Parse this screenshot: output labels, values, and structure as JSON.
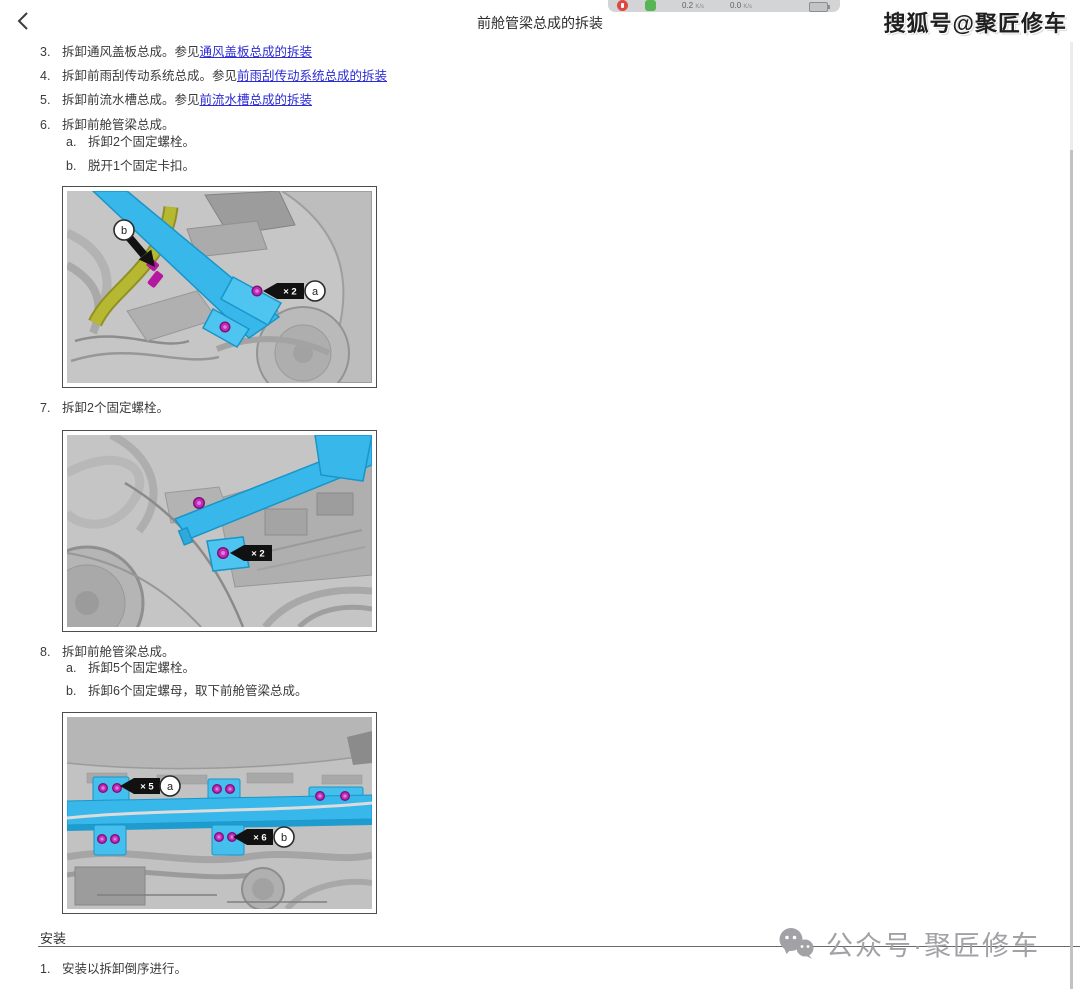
{
  "window": {
    "title": "前舱管梁总成的拆装"
  },
  "toolbar": {
    "down_value": "0.2",
    "down_unit": "K/s",
    "up_value": "0.0",
    "up_unit": "K/s"
  },
  "watermarks": {
    "top_right": "搜狐号@聚匠修车",
    "bottom": "公众号·聚匠修车"
  },
  "steps": {
    "s3": {
      "num": "3.",
      "text": "拆卸通风盖板总成。参见",
      "link": "通风盖板总成的拆装"
    },
    "s4": {
      "num": "4.",
      "text": "拆卸前雨刮传动系统总成。参见",
      "link": "前雨刮传动系统总成的拆装"
    },
    "s5": {
      "num": "5.",
      "text": "拆卸前流水槽总成。参见",
      "link": "前流水槽总成的拆装"
    },
    "s6": {
      "num": "6.",
      "text": "拆卸前舱管梁总成。",
      "a_num": "a.",
      "a_text": "拆卸2个固定螺栓。",
      "b_num": "b.",
      "b_text": "脱开1个固定卡扣。"
    },
    "s7": {
      "num": "7.",
      "text": "拆卸2个固定螺栓。"
    },
    "s8": {
      "num": "8.",
      "text": "拆卸前舱管梁总成。",
      "a_num": "a.",
      "a_text": "拆卸5个固定螺栓。",
      "b_num": "b.",
      "b_text": "拆卸6个固定螺母，取下前舱管梁总成。"
    }
  },
  "install": {
    "heading": "安装",
    "s1_num": "1.",
    "s1_text": "安装以拆卸倒序进行。"
  },
  "figures": {
    "fig1": {
      "label_a": "a",
      "label_b": "b",
      "count_a": "× 2"
    },
    "fig2": {
      "count": "× 2"
    },
    "fig3": {
      "label_a": "a",
      "count_a": "× 5",
      "label_b": "b",
      "count_b": "× 6"
    }
  },
  "colors": {
    "beam": "#38b7ea",
    "bolt": "#c12cbc",
    "hose": "#b6b832",
    "link": "#2b2bd5"
  }
}
